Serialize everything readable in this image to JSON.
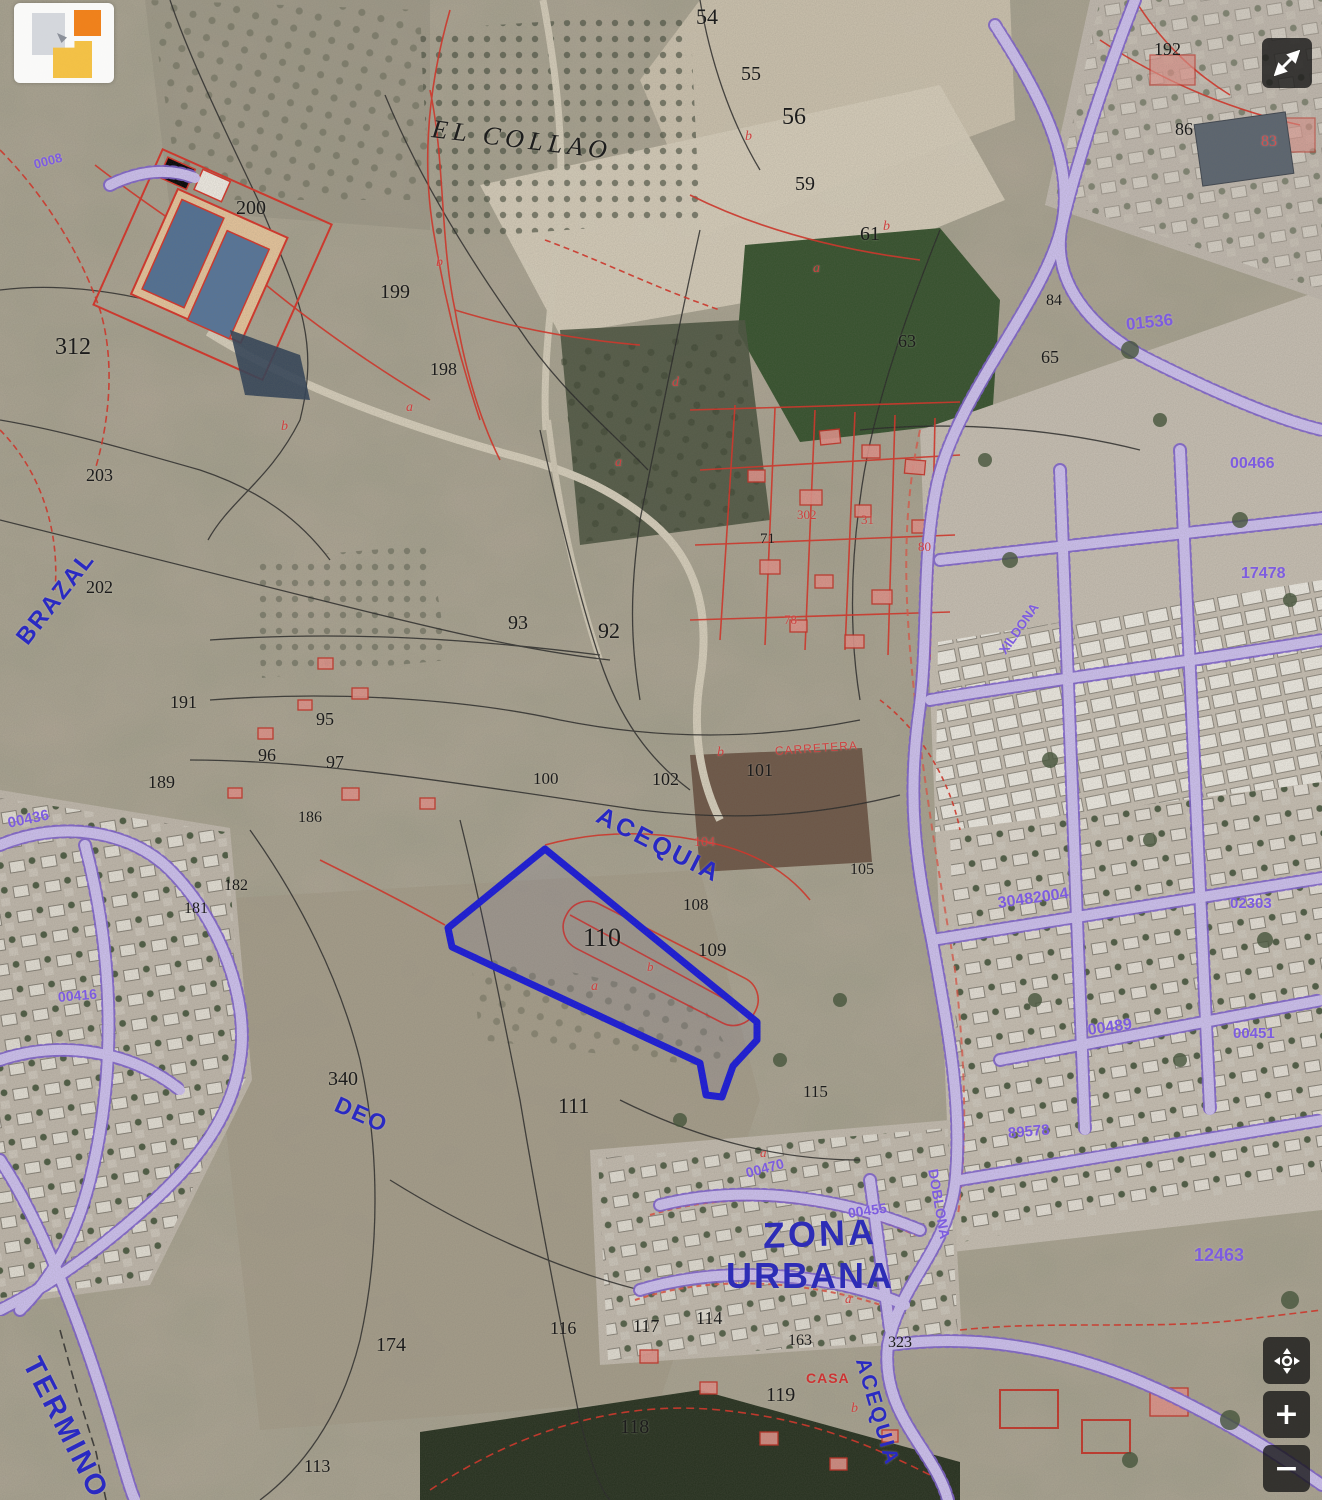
{
  "map": {
    "description": "Cadastral aerial map viewer with highlighted parcel",
    "highlight_color": "#1414dd",
    "cadastral_color": "#d93025",
    "road_color": "#cfc2f3",
    "label_blue": "#2a2ac2",
    "code_purple": "#7d5ce0",
    "labels": [
      {
        "text": "54",
        "x": 696,
        "y": 6,
        "size": 22,
        "color": "#1c1c1c",
        "serif": true
      },
      {
        "text": "55",
        "x": 741,
        "y": 64,
        "size": 20,
        "color": "#1c1c1c",
        "serif": true
      },
      {
        "text": "56",
        "x": 782,
        "y": 105,
        "size": 24,
        "color": "#1c1c1c",
        "serif": true
      },
      {
        "text": "59",
        "x": 795,
        "y": 174,
        "size": 20,
        "color": "#1c1c1c",
        "serif": true
      },
      {
        "text": "61",
        "x": 860,
        "y": 224,
        "size": 20,
        "color": "#1c1c1c",
        "serif": true
      },
      {
        "text": "63",
        "x": 898,
        "y": 332,
        "size": 18,
        "color": "#1c1c1c",
        "serif": true
      },
      {
        "text": "65",
        "x": 1041,
        "y": 348,
        "size": 18,
        "color": "#1c1c1c",
        "serif": true
      },
      {
        "text": "84",
        "x": 1046,
        "y": 293,
        "size": 16,
        "color": "#1c1c1c",
        "serif": true
      },
      {
        "text": "86",
        "x": 1175,
        "y": 120,
        "size": 18,
        "color": "#1c1c1c",
        "serif": true
      },
      {
        "text": "192",
        "x": 1154,
        "y": 40,
        "size": 18,
        "color": "#1c1c1c",
        "serif": true
      },
      {
        "text": "83",
        "x": 1261,
        "y": 134,
        "size": 16,
        "color": "#d05050",
        "serif": true
      },
      {
        "text": "312",
        "x": 55,
        "y": 335,
        "size": 24,
        "color": "#1c1c1c",
        "serif": true
      },
      {
        "text": "200",
        "x": 236,
        "y": 198,
        "size": 20,
        "color": "#1c1c1c",
        "serif": true
      },
      {
        "text": "199",
        "x": 380,
        "y": 282,
        "size": 20,
        "color": "#1c1c1c",
        "serif": true
      },
      {
        "text": "198",
        "x": 430,
        "y": 360,
        "size": 18,
        "color": "#1c1c1c",
        "serif": true
      },
      {
        "text": "203",
        "x": 86,
        "y": 466,
        "size": 18,
        "color": "#1c1c1c",
        "serif": true
      },
      {
        "text": "202",
        "x": 86,
        "y": 578,
        "size": 18,
        "color": "#1c1c1c",
        "serif": true
      },
      {
        "text": "191",
        "x": 170,
        "y": 693,
        "size": 18,
        "color": "#1c1c1c",
        "serif": true
      },
      {
        "text": "95",
        "x": 316,
        "y": 710,
        "size": 18,
        "color": "#1c1c1c",
        "serif": true
      },
      {
        "text": "96",
        "x": 258,
        "y": 746,
        "size": 18,
        "color": "#1c1c1c",
        "serif": true
      },
      {
        "text": "97",
        "x": 326,
        "y": 753,
        "size": 18,
        "color": "#1c1c1c",
        "serif": true
      },
      {
        "text": "189",
        "x": 148,
        "y": 773,
        "size": 18,
        "color": "#1c1c1c",
        "serif": true
      },
      {
        "text": "186",
        "x": 298,
        "y": 810,
        "size": 16,
        "color": "#1c1c1c",
        "serif": true
      },
      {
        "text": "182",
        "x": 224,
        "y": 878,
        "size": 16,
        "color": "#1c1c1c",
        "serif": true
      },
      {
        "text": "181",
        "x": 184,
        "y": 901,
        "size": 16,
        "color": "#1c1c1c",
        "serif": true
      },
      {
        "text": "93",
        "x": 508,
        "y": 613,
        "size": 20,
        "color": "#1c1c1c",
        "serif": true
      },
      {
        "text": "92",
        "x": 598,
        "y": 620,
        "size": 22,
        "color": "#1c1c1c",
        "serif": true
      },
      {
        "text": "100",
        "x": 533,
        "y": 770,
        "size": 17,
        "color": "#1c1c1c",
        "serif": true
      },
      {
        "text": "102",
        "x": 652,
        "y": 770,
        "size": 18,
        "color": "#1c1c1c",
        "serif": true
      },
      {
        "text": "101",
        "x": 746,
        "y": 761,
        "size": 18,
        "color": "#1c1c1c",
        "serif": true
      },
      {
        "text": "71",
        "x": 760,
        "y": 532,
        "size": 15,
        "color": "#1c1c1c",
        "serif": true
      },
      {
        "text": "105",
        "x": 850,
        "y": 862,
        "size": 16,
        "color": "#1c1c1c",
        "serif": true
      },
      {
        "text": "110",
        "x": 583,
        "y": 925,
        "size": 26,
        "color": "#1c1c1c",
        "serif": true
      },
      {
        "text": "109",
        "x": 698,
        "y": 941,
        "size": 19,
        "color": "#1c1c1c",
        "serif": true
      },
      {
        "text": "108",
        "x": 683,
        "y": 896,
        "size": 17,
        "color": "#1c1c1c",
        "serif": true
      },
      {
        "text": "111",
        "x": 558,
        "y": 1095,
        "size": 22,
        "color": "#1c1c1c",
        "serif": true
      },
      {
        "text": "115",
        "x": 803,
        "y": 1083,
        "size": 17,
        "color": "#1c1c1c",
        "serif": true
      },
      {
        "text": "340",
        "x": 328,
        "y": 1069,
        "size": 20,
        "color": "#1c1c1c",
        "serif": true
      },
      {
        "text": "174",
        "x": 376,
        "y": 1335,
        "size": 20,
        "color": "#1c1c1c",
        "serif": true
      },
      {
        "text": "113",
        "x": 304,
        "y": 1457,
        "size": 18,
        "color": "#1c1c1c",
        "serif": true
      },
      {
        "text": "116",
        "x": 550,
        "y": 1319,
        "size": 18,
        "color": "#1c1c1c",
        "serif": true
      },
      {
        "text": "117",
        "x": 633,
        "y": 1317,
        "size": 18,
        "color": "#1c1c1c",
        "serif": true
      },
      {
        "text": "114",
        "x": 696,
        "y": 1309,
        "size": 18,
        "color": "#1c1c1c",
        "serif": true
      },
      {
        "text": "163",
        "x": 788,
        "y": 1333,
        "size": 16,
        "color": "#1c1c1c",
        "serif": true
      },
      {
        "text": "323",
        "x": 888,
        "y": 1335,
        "size": 16,
        "color": "#1c1c1c",
        "serif": true
      },
      {
        "text": "119",
        "x": 766,
        "y": 1385,
        "size": 20,
        "color": "#1c1c1c",
        "serif": true
      },
      {
        "text": "118",
        "x": 620,
        "y": 1417,
        "size": 20,
        "color": "#1c1c1c",
        "serif": true
      },
      {
        "text": "b",
        "x": 745,
        "y": 130,
        "size": 14,
        "color": "#cf4040",
        "italic": true,
        "serif": true
      },
      {
        "text": "b",
        "x": 883,
        "y": 220,
        "size": 14,
        "color": "#cf4040",
        "italic": true,
        "serif": true
      },
      {
        "text": "a",
        "x": 813,
        "y": 262,
        "size": 14,
        "color": "#cf4040",
        "italic": true,
        "serif": true
      },
      {
        "text": "b",
        "x": 436,
        "y": 256,
        "size": 14,
        "color": "#cf4040",
        "italic": true,
        "serif": true
      },
      {
        "text": "a",
        "x": 406,
        "y": 401,
        "size": 14,
        "color": "#cf4040",
        "italic": true,
        "serif": true
      },
      {
        "text": "d",
        "x": 672,
        "y": 376,
        "size": 14,
        "color": "#cf4040",
        "italic": true,
        "serif": true
      },
      {
        "text": "a",
        "x": 615,
        "y": 456,
        "size": 14,
        "color": "#cf4040",
        "italic": true,
        "serif": true
      },
      {
        "text": "b",
        "x": 281,
        "y": 420,
        "size": 14,
        "color": "#cf4040",
        "italic": true,
        "serif": true
      },
      {
        "text": "b",
        "x": 717,
        "y": 746,
        "size": 14,
        "color": "#cf4040",
        "italic": true,
        "serif": true
      },
      {
        "text": "a",
        "x": 591,
        "y": 980,
        "size": 14,
        "color": "#cf4040",
        "italic": true,
        "serif": true
      },
      {
        "text": "b",
        "x": 647,
        "y": 960,
        "size": 13,
        "color": "#cf4040",
        "italic": true,
        "serif": true
      },
      {
        "text": "a",
        "x": 760,
        "y": 1146,
        "size": 13,
        "color": "#cf4040",
        "italic": true,
        "serif": true
      },
      {
        "text": "b",
        "x": 851,
        "y": 1402,
        "size": 14,
        "color": "#cf4040",
        "italic": true,
        "serif": true
      },
      {
        "text": "a",
        "x": 845,
        "y": 1292,
        "size": 13,
        "color": "#cf4040",
        "italic": true,
        "serif": true
      },
      {
        "text": "104",
        "x": 694,
        "y": 836,
        "size": 14,
        "color": "#cf4040",
        "serif": true
      },
      {
        "text": "302",
        "x": 797,
        "y": 508,
        "size": 13,
        "color": "#cf4040",
        "serif": true
      },
      {
        "text": "31",
        "x": 861,
        "y": 513,
        "size": 13,
        "color": "#cf4040",
        "serif": true
      },
      {
        "text": "80",
        "x": 918,
        "y": 540,
        "size": 13,
        "color": "#cf4040",
        "serif": true
      },
      {
        "text": "78",
        "x": 784,
        "y": 613,
        "size": 13,
        "color": "#cf4040",
        "serif": true
      },
      {
        "text": "CASA",
        "x": 806,
        "y": 1371,
        "size": 14,
        "color": "#cc3434",
        "bold": true,
        "spacing": 1
      },
      {
        "text": "CARRETERA",
        "x": 775,
        "y": 745,
        "size": 12,
        "color": "#cf4040",
        "rot": -4,
        "spacing": 1
      },
      {
        "text": "EL COLLAO",
        "x": 432,
        "y": 116,
        "size": 26,
        "color": "#1d1d1d",
        "rot": 7,
        "italic": true,
        "serif": true,
        "spacing": 5
      },
      {
        "text": "BRAZAL",
        "x": 22,
        "y": 630,
        "size": 24,
        "color": "#2a2ac2",
        "rot": -52,
        "bold": true,
        "spacing": 2
      },
      {
        "text": "ACEQUIA",
        "x": 598,
        "y": 802,
        "size": 25,
        "color": "#2828c4",
        "rot": 27,
        "bold": true,
        "spacing": 3
      },
      {
        "text": "DEO",
        "x": 336,
        "y": 1092,
        "size": 23,
        "color": "#2a2ac2",
        "rot": 24,
        "bold": true,
        "spacing": 2
      },
      {
        "text": "ZONA",
        "x": 763,
        "y": 1218,
        "size": 36,
        "color": "#2d2db6",
        "rot": -2,
        "bold": true,
        "spacing": 3
      },
      {
        "text": "URBANA",
        "x": 726,
        "y": 1258,
        "size": 36,
        "color": "#2d2db6",
        "bold": true,
        "spacing": 2
      },
      {
        "text": "ACEQUIA",
        "x": 862,
        "y": 1348,
        "size": 21,
        "color": "#2a2ac2",
        "rot": 74,
        "bold": true,
        "spacing": 2
      },
      {
        "text": "TERMINO",
        "x": 30,
        "y": 1345,
        "size": 29,
        "color": "#2a2ac2",
        "rot": 63,
        "bold": true,
        "spacing": 3
      },
      {
        "text": "0008",
        "x": 34,
        "y": 158,
        "size": 13,
        "color": "#7d5ce0",
        "rot": -15,
        "bold": true
      },
      {
        "text": "01536",
        "x": 1126,
        "y": 316,
        "size": 17,
        "color": "#7d5ce0",
        "rot": -6,
        "bold": true
      },
      {
        "text": "00466",
        "x": 1230,
        "y": 456,
        "size": 16,
        "color": "#7d5ce0",
        "bold": true
      },
      {
        "text": "17478",
        "x": 1241,
        "y": 566,
        "size": 16,
        "color": "#7d5ce0",
        "bold": true
      },
      {
        "text": "XILDONA",
        "x": 1002,
        "y": 646,
        "size": 13,
        "color": "#7d5ce0",
        "rot": -55,
        "bold": true
      },
      {
        "text": "30482004",
        "x": 998,
        "y": 896,
        "size": 16,
        "color": "#7d5ce0",
        "rot": -8,
        "bold": true
      },
      {
        "text": "02303",
        "x": 1230,
        "y": 896,
        "size": 15,
        "color": "#7d5ce0",
        "bold": true
      },
      {
        "text": "00489",
        "x": 1088,
        "y": 1023,
        "size": 16,
        "color": "#7d5ce0",
        "rot": -8,
        "bold": true
      },
      {
        "text": "00451",
        "x": 1233,
        "y": 1026,
        "size": 15,
        "color": "#7d5ce0",
        "bold": true
      },
      {
        "text": "89578",
        "x": 1008,
        "y": 1126,
        "size": 15,
        "color": "#7d5ce0",
        "rot": -5,
        "bold": true
      },
      {
        "text": "12463",
        "x": 1194,
        "y": 1246,
        "size": 18,
        "color": "#7d5ce0",
        "bold": true
      },
      {
        "text": "00436",
        "x": 8,
        "y": 816,
        "size": 15,
        "color": "#7d5ce0",
        "rot": -12,
        "bold": true
      },
      {
        "text": "00416",
        "x": 58,
        "y": 990,
        "size": 14,
        "color": "#7d5ce0",
        "rot": -5,
        "bold": true
      },
      {
        "text": "00470",
        "x": 746,
        "y": 1166,
        "size": 14,
        "color": "#7d5ce0",
        "rot": -15,
        "bold": true
      },
      {
        "text": "00455",
        "x": 848,
        "y": 1206,
        "size": 14,
        "color": "#7d5ce0",
        "rot": -8,
        "bold": true
      },
      {
        "text": "DOBLONA",
        "x": 933,
        "y": 1162,
        "size": 14,
        "color": "#7d5ce0",
        "rot": 80,
        "bold": true
      }
    ]
  },
  "controls": {
    "zoom_in": "+",
    "zoom_out": "−"
  },
  "icons": {
    "fullscreen": "expand-arrows",
    "pan": "move-cross",
    "zoom_in": "plus",
    "zoom_out": "minus",
    "logo": "catastro-squares"
  }
}
